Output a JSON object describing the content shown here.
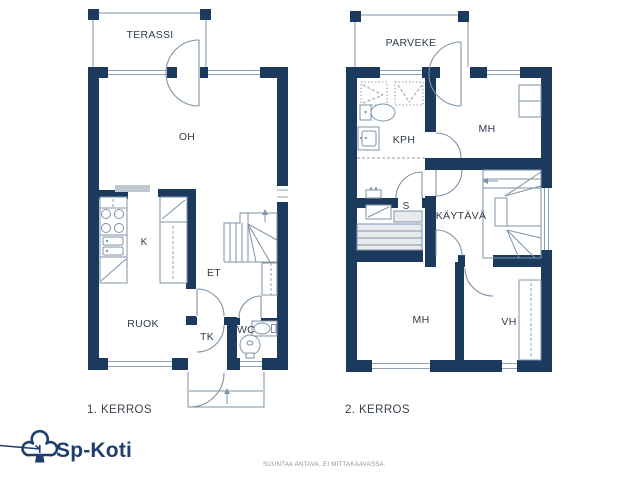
{
  "floor1": {
    "caption": "1. KERROS",
    "rooms": {
      "terassi": "TERASSI",
      "oh": "OH",
      "k": "K",
      "et": "ET",
      "ruok": "RUOK",
      "tk": "TK",
      "wc": "WC"
    }
  },
  "floor2": {
    "caption": "2. KERROS",
    "rooms": {
      "parveke": "PARVEKE",
      "kph": "KPH",
      "mh_top": "MH",
      "s": "S",
      "kaytava": "KÄYTÄVÄ",
      "mh_bottom": "MH",
      "vh": "VH"
    }
  },
  "branding": {
    "logo_text": "Sp-Koti"
  },
  "footer": {
    "disclaimer": "SUUNTAA ANTAVA, EI MITTAKAAVASSA."
  },
  "colors": {
    "wall": "#1c3a5e",
    "line": "#7e93a7",
    "label": "#2e3b49",
    "logo": "#1e3e6e",
    "bench_fill": "#e8ebed",
    "counter_gray": "#bfc7cf",
    "disclaimer_text": "#8d9298"
  }
}
